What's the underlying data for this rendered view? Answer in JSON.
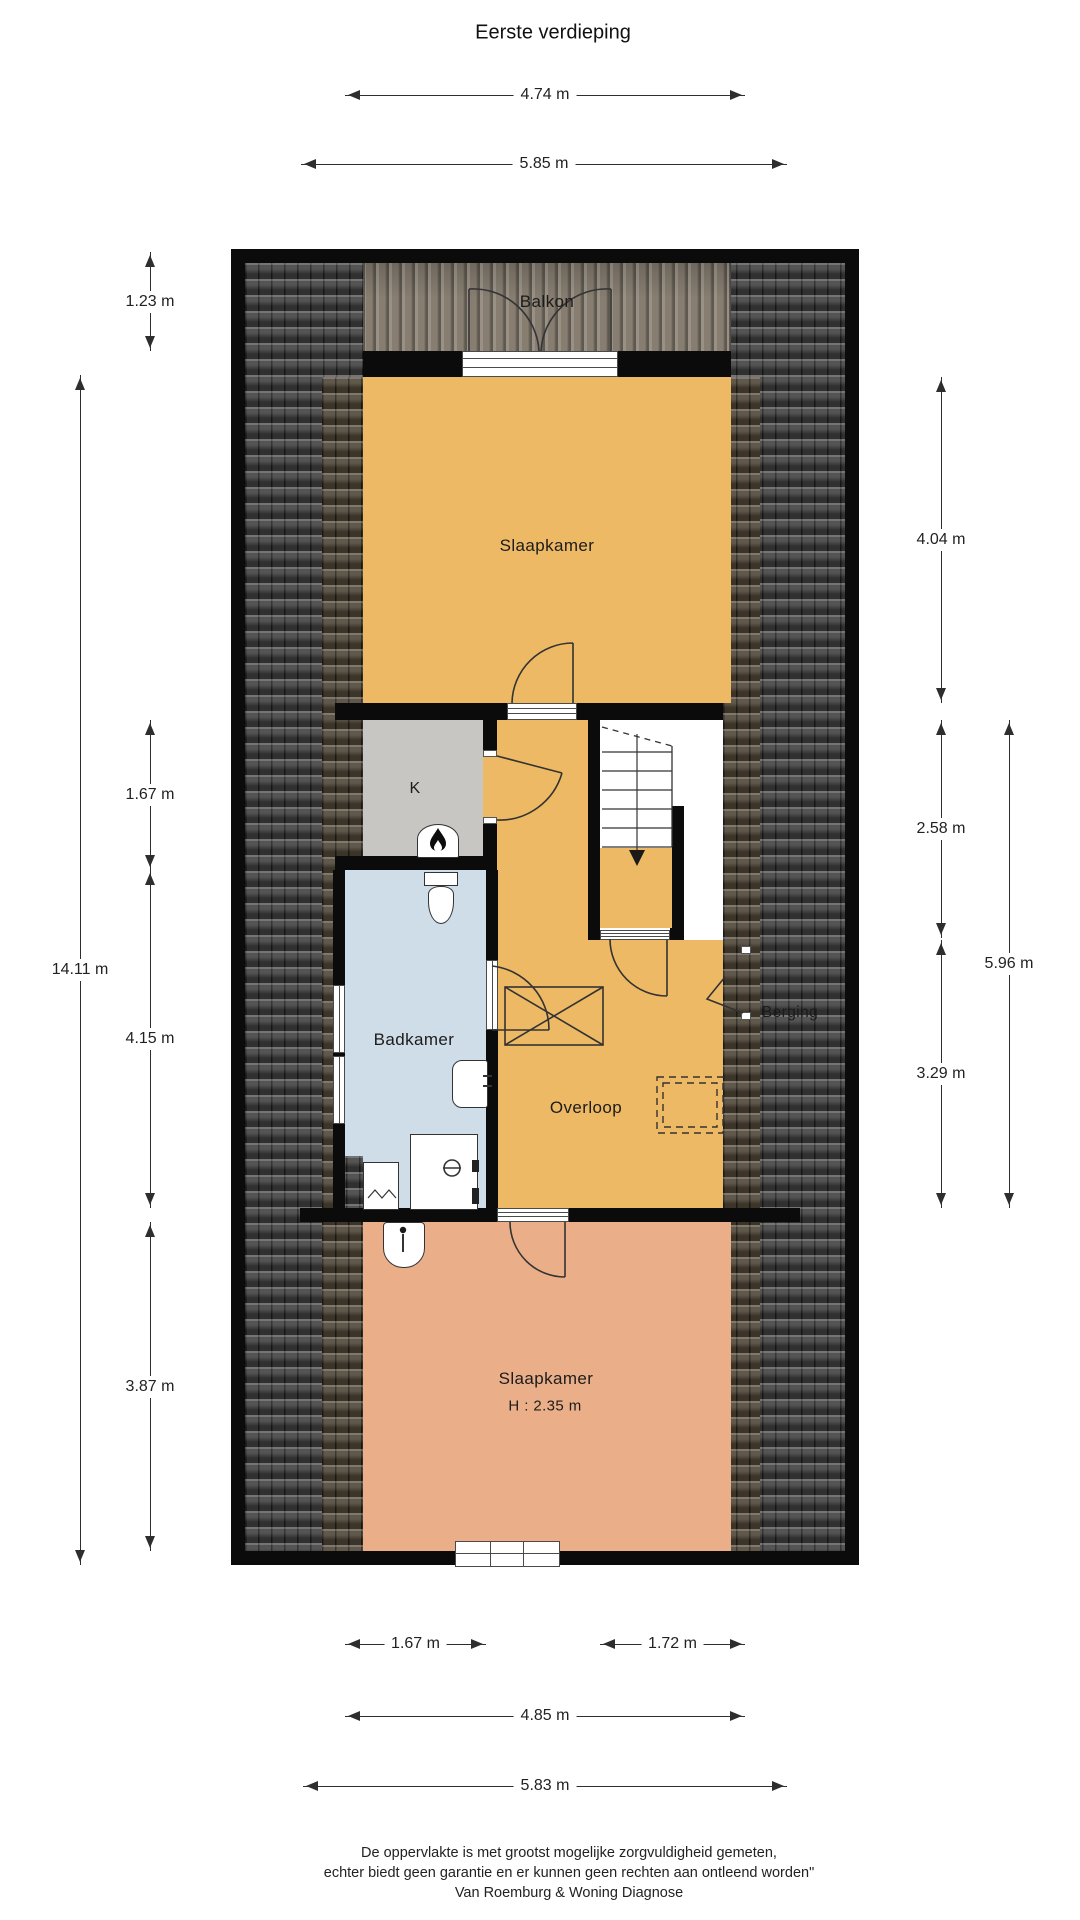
{
  "title": "Eerste verdieping",
  "rooms": {
    "balkon": "Balkon",
    "slaapkamer_boven": "Slaapkamer",
    "kast": "K",
    "badkamer": "Badkamer",
    "overloop": "Overloop",
    "berging": "Berging",
    "slaapkamer_onder": "Slaapkamer",
    "slaapkamer_onder_hoogte": "H : 2.35 m"
  },
  "dimensions": {
    "top": [
      "4.74 m",
      "5.85 m"
    ],
    "left": [
      "1.23 m",
      "14.11 m",
      "1.67 m",
      "4.15 m",
      "3.87 m"
    ],
    "right": [
      "4.04 m",
      "2.58 m",
      "3.29 m",
      "5.96 m"
    ],
    "bottom": [
      "1.67 m",
      "1.72 m",
      "4.85 m",
      "5.83 m"
    ]
  },
  "footer": {
    "line1": "De oppervlakte is met grootst mogelijke zorgvuldigheid gemeten,",
    "line2": "echter biedt geen garantie en er kunnen geen rechten aan ontleend worden\"",
    "line3": "Van Roemburg & Woning Diagnose"
  },
  "colors": {
    "wall": "#0b0b0b",
    "floor_orange": "#eeb965",
    "floor_peach": "#eaaf89",
    "floor_blue": "#cfdde9",
    "floor_gray": "#c7c6c2",
    "roof_dark": "#454545",
    "roof_brown": "#554a3b",
    "deck_wood": "#877e71",
    "line": "#2e2e2e",
    "text": "#1c1c1c",
    "white": "#ffffff"
  }
}
